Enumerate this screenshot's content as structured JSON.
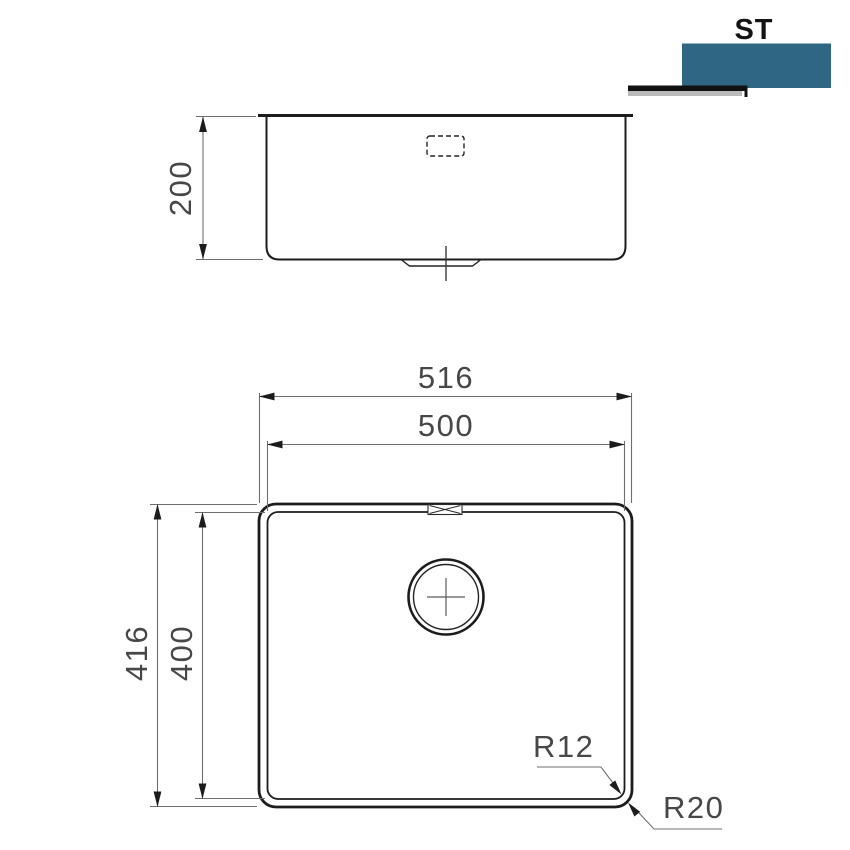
{
  "brand": {
    "logo_text": "ST",
    "accent_color": "#2e6683",
    "underline_color": "#111111",
    "underline_shadow_color": "#bbbbbb"
  },
  "colors": {
    "object_line": "#1c1c1c",
    "dimension_line": "#6f6f6f",
    "dimension_text": "#474747",
    "background": "#ffffff"
  },
  "side_view": {
    "height_dim": "200"
  },
  "top_view": {
    "overall_width_dim": "516",
    "bowl_width_dim": "500",
    "overall_depth_dim": "416",
    "bowl_depth_dim": "400",
    "bowl_corner_radius": "R12",
    "outer_corner_radius": "R20"
  }
}
